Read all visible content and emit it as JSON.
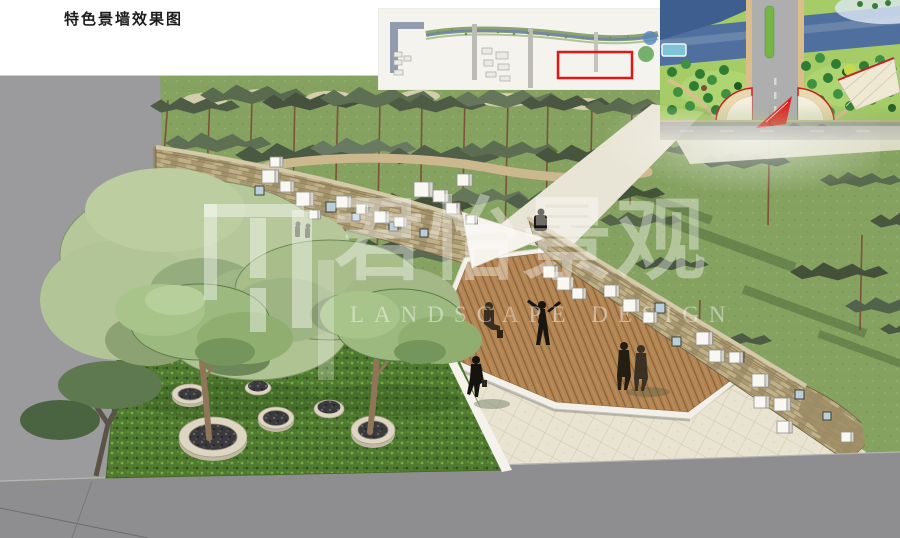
{
  "page": {
    "title": "特色景墙效果图"
  },
  "watermark": {
    "cn": "君怡景观",
    "en": "LANDSCAPE DESIGN"
  },
  "insets": {
    "strip_plan": {
      "highlight_color": "#e51515"
    },
    "master_plan": {
      "arrow_color": "#e31e1e"
    }
  },
  "palette": {
    "paper": "#ffffff",
    "grass": "#86a261",
    "shrub": "#4f7a2f",
    "pine_dark": "#46523d",
    "stone_wall": "#b2a37b",
    "deck_wood": "#b28554",
    "paving": "#e9e4d1",
    "road": "#8e8e90",
    "offsite_gray": "#9b9b9d",
    "highlight_red": "#e51515"
  }
}
